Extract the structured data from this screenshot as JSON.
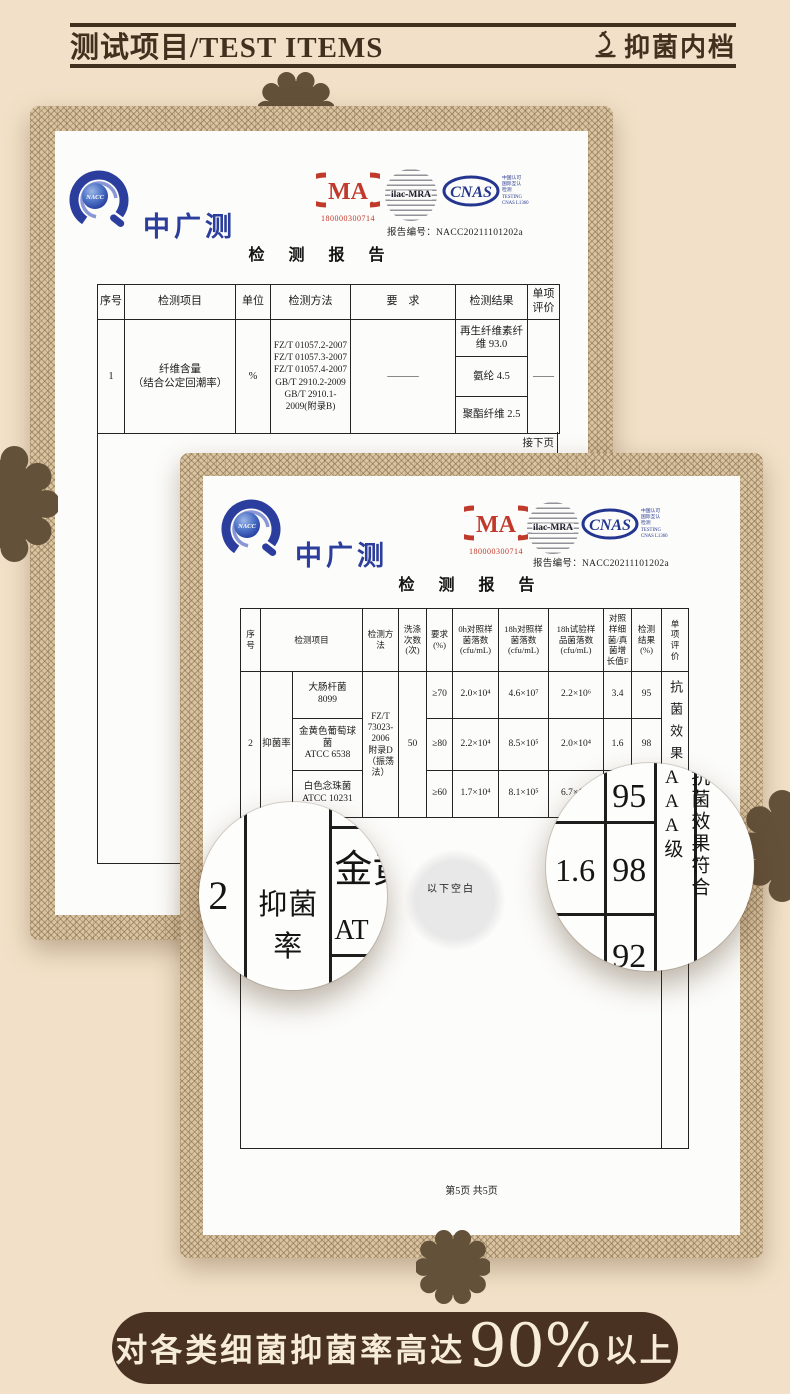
{
  "header": {
    "title": "测试项目/TEST ITEMS",
    "tag": "抑菌内档"
  },
  "lab": {
    "name": "中广测",
    "badge": "NACC",
    "cma": {
      "label": "MA",
      "number": "180000300714"
    },
    "ilac": {
      "label": "ilac-MRA"
    },
    "cnas": {
      "label": "CNAS",
      "side": "中国认可\n国际互认\n检测\nTESTING\nCNAS L1360"
    },
    "report_no_label": "报告编号：",
    "report_no": "NACC20211101202a",
    "report_title": "检 测 报 告"
  },
  "report1": {
    "table": {
      "headers": [
        "序号",
        "检测项目",
        "单位",
        "检测方法",
        "要　求",
        "检测结果",
        "单项\n评价"
      ],
      "row": {
        "no": "1",
        "item": "纤维含量\n（结合公定回潮率）",
        "unit": "%",
        "method": "FZ/T 01057.2-2007\nFZ/T 01057.3-2007\nFZ/T 01057.4-2007\nGB/T 2910.2-2009\nGB/T 2910.1-\n2009(附录B)",
        "requirement": "———",
        "results": [
          "再生纤维素纤\n维 93.0",
          "氨纶 4.5",
          "聚酯纤维 2.5"
        ],
        "evaluation": "——"
      },
      "continued_note": "接下页"
    }
  },
  "report2": {
    "table": {
      "headers": [
        "序\n号",
        "检测项目",
        "检测方\n法",
        "洗涤\n次数\n(次)",
        "要求\n(%)",
        "0h对照样\n菌落数\n(cfu/mL)",
        "18h对照样\n菌落数\n(cfu/mL)",
        "18h试验样\n品菌落数\n(cfu/mL)",
        "对照\n样细\n菌/真\n菌增\n长值F",
        "检测\n结果\n(%)",
        "单\n项\n评\n价"
      ],
      "row_no": "2",
      "item": "抑菌率",
      "method": "FZ/T\n73023-\n2006\n附录D\n（振荡\n法）",
      "wash_cycles": "50",
      "organisms": [
        {
          "name": "大肠杆菌\n8099",
          "requirement": "≥70",
          "count_0h": "2.0×10⁴",
          "count_18h_control": "4.6×10⁷",
          "count_18h_sample": "2.2×10⁶",
          "growth_f": "3.4",
          "result": "95"
        },
        {
          "name": "金黄色葡萄球\n菌\nATCC 6538",
          "requirement": "≥80",
          "count_0h": "2.2×10⁴",
          "count_18h_control": "8.5×10⁵",
          "count_18h_sample": "2.0×10⁴",
          "growth_f": "1.6",
          "result": "98"
        },
        {
          "name": "白色念珠菌\nATCC 10231",
          "requirement": "≥60",
          "count_0h": "1.7×10⁴",
          "count_18h_control": "8.1×10⁵",
          "count_18h_sample": "6.7×10⁴",
          "growth_f": "",
          "result": "92"
        }
      ],
      "evaluation": "抗菌效果符合AAA级",
      "blank_note": "以下空白"
    },
    "page_footer": "第5页 共5页"
  },
  "magnifiers": {
    "left": {
      "no": "2",
      "item": "抑菌率",
      "partial_top": "金黄",
      "partial_bottom": "AT"
    },
    "right": {
      "r1": "95",
      "f2": "1.6",
      "r2": "98",
      "r3": "92",
      "evaluation": "抗菌效果符合AAA级"
    }
  },
  "banner": {
    "prefix": "对各类细菌抑菌率高达",
    "highlight": "90%",
    "suffix": "以上"
  },
  "colors": {
    "background": "#f2e1c8",
    "ink": "#42301f",
    "banner_bg": "#4a3222",
    "banner_text": "#f6ecd8",
    "logo_blue": "#2c3e9d",
    "cma_red": "#c0392b",
    "lace": "#d9c3a1",
    "flower": "#64513a"
  }
}
